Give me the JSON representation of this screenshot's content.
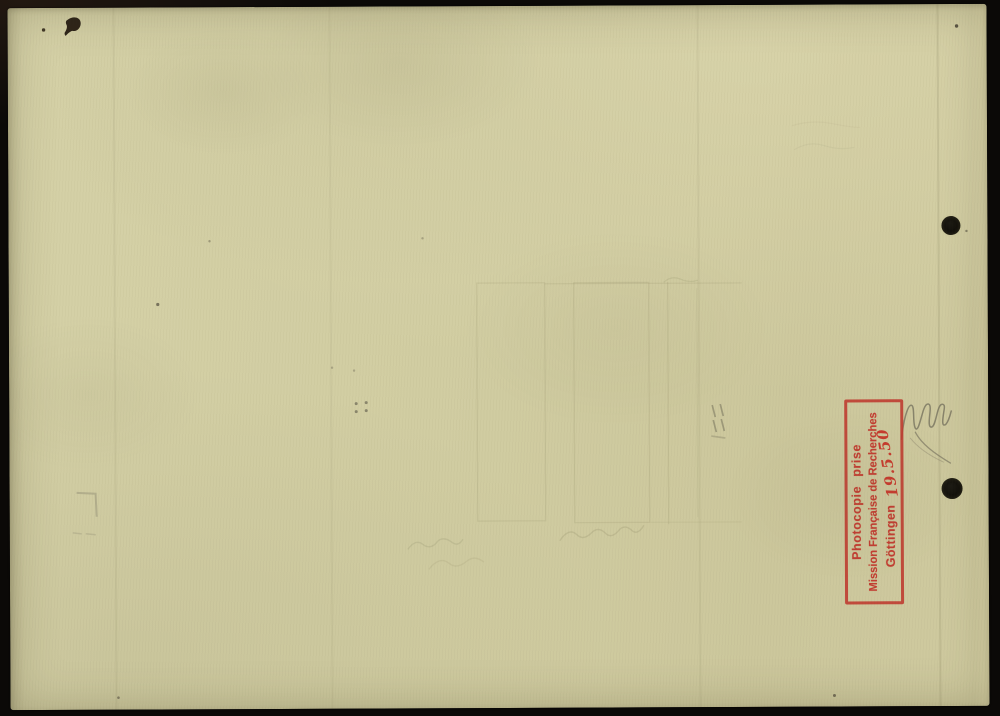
{
  "scan": {
    "background_color": "#0b0907",
    "paper_color": "#d1cda2"
  },
  "stamp": {
    "line1": "Photocopie prise",
    "line2": "Mission Française de Recherches",
    "line3": "Göttingen",
    "date": "19.5.50",
    "ink_color": "#c2392e"
  }
}
